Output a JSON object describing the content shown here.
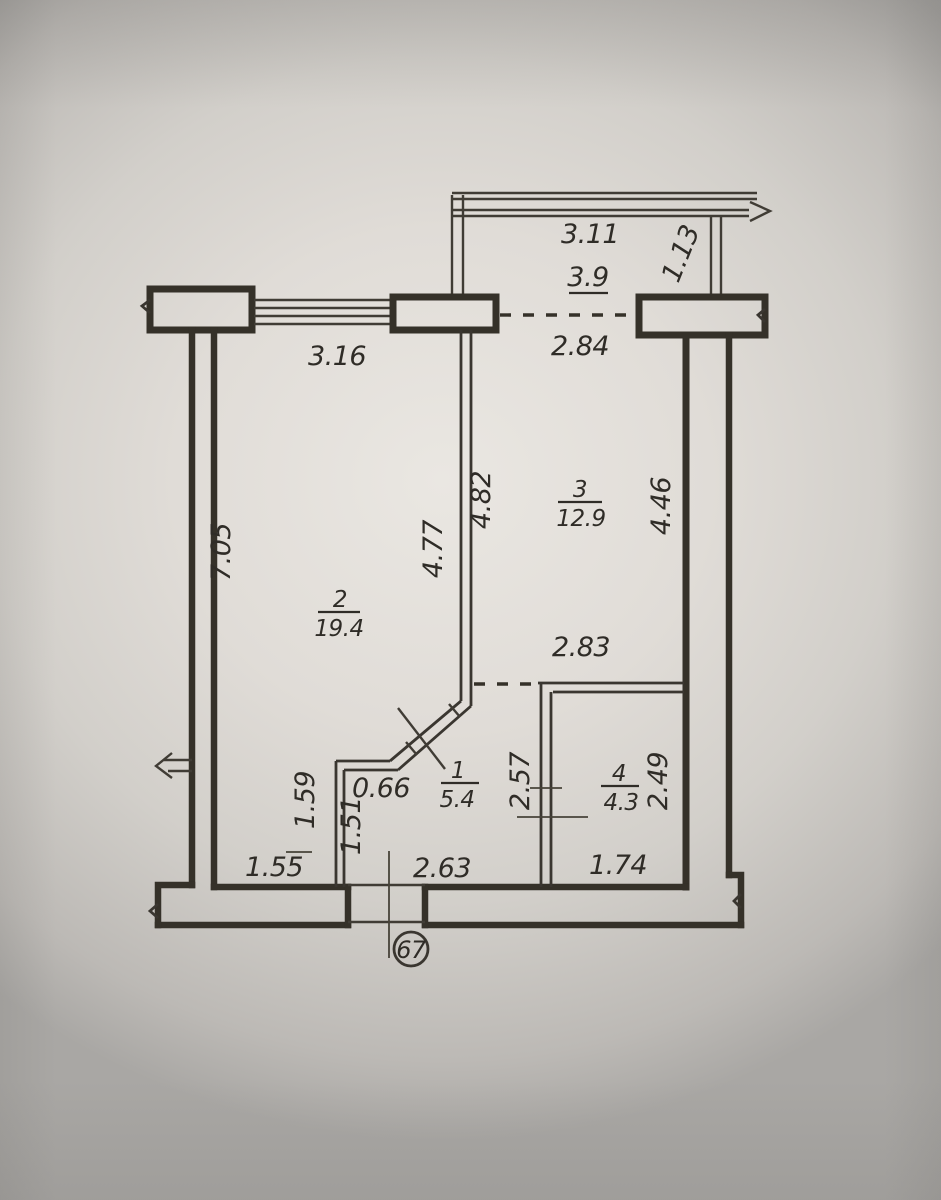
{
  "plan": {
    "apartment_number": "67",
    "rooms": {
      "r1": {
        "number": "1",
        "area": "5.4"
      },
      "r2": {
        "number": "2",
        "area": "19.4"
      },
      "r3": {
        "number": "3",
        "area": "12.9"
      },
      "r4": {
        "number": "4",
        "area": "4.3"
      }
    },
    "balcony": {
      "width": "3.11",
      "area": "3.9",
      "depth": "1.13"
    },
    "dims": {
      "window_wall": "3.16",
      "balcony_opening": "2.84",
      "left_wall": "7.05",
      "room2_right": "4.77",
      "room3_left": "4.82",
      "room3_right": "4.46",
      "room3_bottom": "2.83",
      "hall_door": "0.66",
      "partition_room2": "1.59",
      "partition_hall": "1.51",
      "room2_bottom": "1.55",
      "hall_bottom": "2.63",
      "room4_left": "2.57",
      "room4_right": "2.49",
      "room4_bottom": "1.74"
    },
    "ink_color": "#35322d",
    "paper_color": "#dcd8d3"
  }
}
